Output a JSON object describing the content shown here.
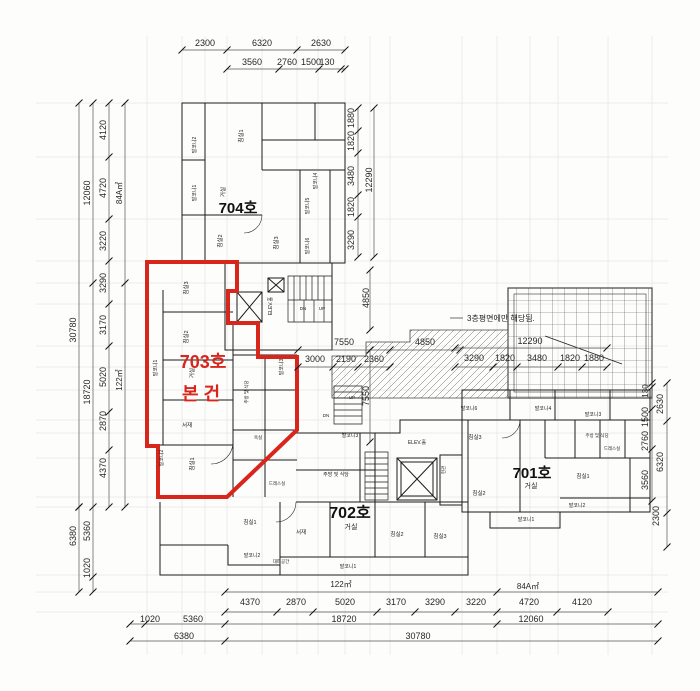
{
  "canvas": {
    "width": 700,
    "height": 691
  },
  "colors": {
    "red": "#d9261c",
    "wall": "#1c1c1c",
    "dim": "#2a2a2a",
    "ruler": "#555"
  },
  "units": {
    "u704": {
      "label": "704호"
    },
    "u703": {
      "label": "703호"
    },
    "subject": {
      "label": "본 건"
    },
    "u702": {
      "label": "702호"
    },
    "u701": {
      "label": "701호"
    }
  },
  "note": {
    "text": "3층평면에만 해당됨."
  },
  "dims": [
    {
      "t": "2300",
      "x": 205,
      "y": 46
    },
    {
      "t": "6320",
      "x": 262,
      "y": 46
    },
    {
      "t": "2630",
      "x": 321,
      "y": 46
    },
    {
      "t": "3560",
      "x": 252,
      "y": 65
    },
    {
      "t": "2760",
      "x": 287,
      "y": 65
    },
    {
      "t": "1500",
      "x": 311,
      "y": 65
    },
    {
      "t": "130",
      "x": 327,
      "y": 65
    },
    {
      "t": "30780",
      "x": 76,
      "y": 330,
      "r": -90
    },
    {
      "t": "12060",
      "x": 90,
      "y": 193,
      "r": -90
    },
    {
      "t": "18720",
      "x": 90,
      "y": 392,
      "r": -90
    },
    {
      "t": "4120",
      "x": 106,
      "y": 130,
      "r": -90
    },
    {
      "t": "4720",
      "x": 106,
      "y": 188,
      "r": -90
    },
    {
      "t": "3220",
      "x": 106,
      "y": 241,
      "r": -90
    },
    {
      "t": "3290",
      "x": 106,
      "y": 283,
      "r": -90
    },
    {
      "t": "3170",
      "x": 106,
      "y": 325,
      "r": -90
    },
    {
      "t": "5020",
      "x": 106,
      "y": 377,
      "r": -90
    },
    {
      "t": "2870",
      "x": 106,
      "y": 421,
      "r": -90
    },
    {
      "t": "4370",
      "x": 106,
      "y": 468,
      "r": -90
    },
    {
      "t": "84A㎡",
      "x": 122,
      "y": 193,
      "r": -90,
      "s": 8
    },
    {
      "t": "122㎡",
      "x": 122,
      "y": 380,
      "r": -90,
      "s": 8
    },
    {
      "t": "6380",
      "x": 76,
      "y": 536,
      "r": -90
    },
    {
      "t": "5360",
      "x": 90,
      "y": 531,
      "r": -90
    },
    {
      "t": "1020",
      "x": 90,
      "y": 568,
      "r": -90
    },
    {
      "t": "1880",
      "x": 354,
      "y": 118,
      "r": -90
    },
    {
      "t": "1820",
      "x": 354,
      "y": 141,
      "r": -90
    },
    {
      "t": "3480",
      "x": 354,
      "y": 176,
      "r": -90
    },
    {
      "t": "1820",
      "x": 354,
      "y": 207,
      "r": -90
    },
    {
      "t": "3290",
      "x": 354,
      "y": 240,
      "r": -90
    },
    {
      "t": "12290",
      "x": 372,
      "y": 180,
      "r": -90
    },
    {
      "t": "12290",
      "x": 530,
      "y": 344
    },
    {
      "t": "3290",
      "x": 474,
      "y": 361
    },
    {
      "t": "1820",
      "x": 505,
      "y": 361
    },
    {
      "t": "3480",
      "x": 537,
      "y": 361
    },
    {
      "t": "1820",
      "x": 570,
      "y": 361
    },
    {
      "t": "1880",
      "x": 594,
      "y": 361
    },
    {
      "t": "7550",
      "x": 344,
      "y": 345
    },
    {
      "t": "4850",
      "x": 425,
      "y": 345
    },
    {
      "t": "3000",
      "x": 315,
      "y": 362
    },
    {
      "t": "2190",
      "x": 346,
      "y": 362
    },
    {
      "t": "2360",
      "x": 374,
      "y": 362
    },
    {
      "t": "4850",
      "x": 369,
      "y": 298,
      "r": -90
    },
    {
      "t": "7550",
      "x": 369,
      "y": 396,
      "r": -90
    },
    {
      "t": "130",
      "x": 648,
      "y": 391,
      "r": -90,
      "s": 8
    },
    {
      "t": "1500",
      "x": 648,
      "y": 417,
      "r": -90
    },
    {
      "t": "2760",
      "x": 648,
      "y": 441,
      "r": -90
    },
    {
      "t": "3560",
      "x": 648,
      "y": 480,
      "r": -90
    },
    {
      "t": "2630",
      "x": 663,
      "y": 404,
      "r": -90
    },
    {
      "t": "6320",
      "x": 663,
      "y": 462,
      "r": -90
    },
    {
      "t": "2300",
      "x": 659,
      "y": 516,
      "r": -90
    },
    {
      "t": "122㎡",
      "x": 341,
      "y": 587,
      "s": 8
    },
    {
      "t": "84A㎡",
      "x": 528,
      "y": 589,
      "s": 8
    },
    {
      "t": "4370",
      "x": 250,
      "y": 605
    },
    {
      "t": "2870",
      "x": 296,
      "y": 605
    },
    {
      "t": "5020",
      "x": 345,
      "y": 605
    },
    {
      "t": "3170",
      "x": 396,
      "y": 605
    },
    {
      "t": "3290",
      "x": 435,
      "y": 605
    },
    {
      "t": "3220",
      "x": 476,
      "y": 605
    },
    {
      "t": "4720",
      "x": 529,
      "y": 605
    },
    {
      "t": "4120",
      "x": 582,
      "y": 605
    },
    {
      "t": "1020",
      "x": 150,
      "y": 622
    },
    {
      "t": "5360",
      "x": 193,
      "y": 622
    },
    {
      "t": "18720",
      "x": 344,
      "y": 622
    },
    {
      "t": "12060",
      "x": 531,
      "y": 622
    },
    {
      "t": "6380",
      "x": 184,
      "y": 639
    },
    {
      "t": "30780",
      "x": 418,
      "y": 639
    }
  ],
  "rooms": [
    {
      "t": "거실",
      "x": 225,
      "y": 192,
      "r": -90
    },
    {
      "t": "침실1",
      "x": 243,
      "y": 136,
      "r": -90
    },
    {
      "t": "발코니2",
      "x": 196,
      "y": 145,
      "r": -90,
      "s": 5
    },
    {
      "t": "발코니1",
      "x": 196,
      "y": 193,
      "r": -90,
      "s": 5
    },
    {
      "t": "침실2",
      "x": 222,
      "y": 241,
      "r": -90
    },
    {
      "t": "침실3",
      "x": 278,
      "y": 243,
      "r": -90
    },
    {
      "t": "발코니4",
      "x": 317,
      "y": 181,
      "r": -90,
      "s": 5
    },
    {
      "t": "발코니5",
      "x": 309,
      "y": 206,
      "r": -90,
      "s": 5
    },
    {
      "t": "발코니6",
      "x": 309,
      "y": 246,
      "r": -90,
      "s": 5
    },
    {
      "t": "ELEV.홀",
      "x": 272,
      "y": 306,
      "r": -90,
      "s": 5
    },
    {
      "t": "DN",
      "x": 303,
      "y": 310,
      "s": 4.5
    },
    {
      "t": "UP",
      "x": 322,
      "y": 310,
      "s": 4.5
    },
    {
      "t": "침실3",
      "x": 188,
      "y": 288,
      "r": -90
    },
    {
      "t": "침실2",
      "x": 188,
      "y": 337,
      "r": -90
    },
    {
      "t": "발코니1",
      "x": 157,
      "y": 368,
      "r": -90,
      "s": 5
    },
    {
      "t": "거실",
      "x": 194,
      "y": 373,
      "r": -90
    },
    {
      "t": "서재",
      "x": 187,
      "y": 427
    },
    {
      "t": "침실1",
      "x": 194,
      "y": 464,
      "r": -90
    },
    {
      "t": "발코니2",
      "x": 163,
      "y": 458,
      "r": -90,
      "s": 5
    },
    {
      "t": "발코니3",
      "x": 283,
      "y": 367,
      "r": -90,
      "s": 5
    },
    {
      "t": "주방 및 식당",
      "x": 248,
      "y": 392,
      "r": -90,
      "s": 4.5
    },
    {
      "t": "드레스실",
      "x": 277,
      "y": 485,
      "s": 4.5
    },
    {
      "t": "욕실",
      "x": 258,
      "y": 439,
      "s": 4.5
    },
    {
      "t": "UP",
      "x": 352,
      "y": 399,
      "s": 4.5
    },
    {
      "t": "DN",
      "x": 326,
      "y": 417,
      "s": 4.5
    },
    {
      "t": "거실",
      "x": 351,
      "y": 529,
      "s": 7
    },
    {
      "t": "서재",
      "x": 301,
      "y": 534
    },
    {
      "t": "침실1",
      "x": 250,
      "y": 524
    },
    {
      "t": "침실2",
      "x": 397,
      "y": 536
    },
    {
      "t": "침실3",
      "x": 440,
      "y": 538
    },
    {
      "t": "발코니1",
      "x": 348,
      "y": 568,
      "s": 5
    },
    {
      "t": "발코니2",
      "x": 252,
      "y": 557,
      "s": 5
    },
    {
      "t": "대피공간",
      "x": 281,
      "y": 563,
      "s": 4.5
    },
    {
      "t": "발코니3",
      "x": 350,
      "y": 437,
      "s": 5
    },
    {
      "t": "주방 및 식당",
      "x": 336,
      "y": 476,
      "s": 5
    },
    {
      "t": "ELEV.홀",
      "x": 417,
      "y": 444,
      "s": 5
    },
    {
      "t": "현관",
      "x": 445,
      "y": 470,
      "r": -90,
      "s": 4.5
    },
    {
      "t": "거실",
      "x": 531,
      "y": 488,
      "s": 7
    },
    {
      "t": "침실1",
      "x": 583,
      "y": 478
    },
    {
      "t": "침실2",
      "x": 479,
      "y": 495
    },
    {
      "t": "침실3",
      "x": 475,
      "y": 439
    },
    {
      "t": "발코니6",
      "x": 469,
      "y": 410,
      "s": 5
    },
    {
      "t": "발코니4",
      "x": 543,
      "y": 410,
      "s": 5
    },
    {
      "t": "발코니3",
      "x": 593,
      "y": 416,
      "s": 5
    },
    {
      "t": "발코니1",
      "x": 526,
      "y": 521,
      "s": 5
    },
    {
      "t": "발코니2",
      "x": 577,
      "y": 507,
      "s": 5
    },
    {
      "t": "주방 및 식당",
      "x": 597,
      "y": 437,
      "s": 4.5
    },
    {
      "t": "드레스실",
      "x": 612,
      "y": 450,
      "s": 4.5
    }
  ]
}
